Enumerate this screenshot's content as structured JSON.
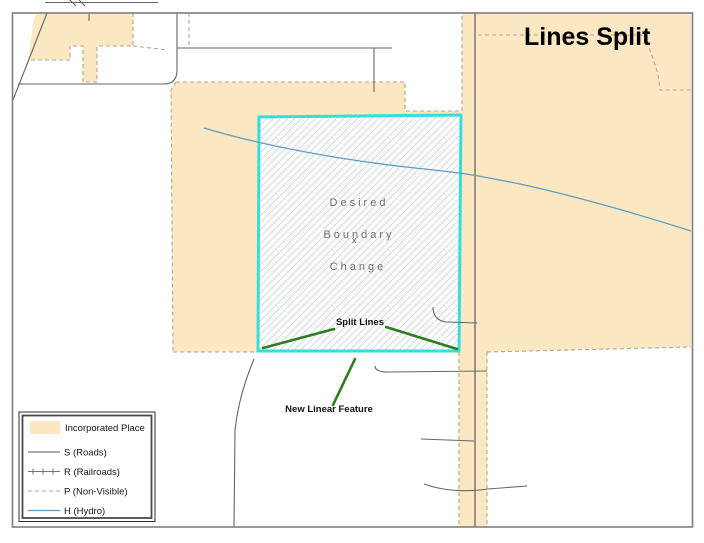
{
  "map": {
    "title": "Lines Split",
    "region_labels": [
      "Desired",
      "Boundary",
      "Change"
    ],
    "annotations": {
      "split_lines": "Split Lines",
      "new_linear_feature": "New Linear Feature"
    },
    "node_marker": "x"
  },
  "legend": {
    "items": [
      {
        "symbol": "incorporated-place-swatch",
        "label": "Incorporated Place"
      },
      {
        "symbol": "roads-line",
        "label": "S (Roads)"
      },
      {
        "symbol": "railroads-line",
        "label": "R (Railroads)"
      },
      {
        "symbol": "nonvisible-line",
        "label": "P (Non-Visible)"
      },
      {
        "symbol": "hydro-line",
        "label": "H (Hydro)"
      }
    ]
  },
  "colors": {
    "incorporated_place": "#FBE8C2",
    "boundary_change_outline": "#35DEDA",
    "hydro": "#5B9EC4",
    "annotation_green": "#2E7D1E",
    "road": "#666666",
    "nonvisible_dash": "#B2A794"
  }
}
